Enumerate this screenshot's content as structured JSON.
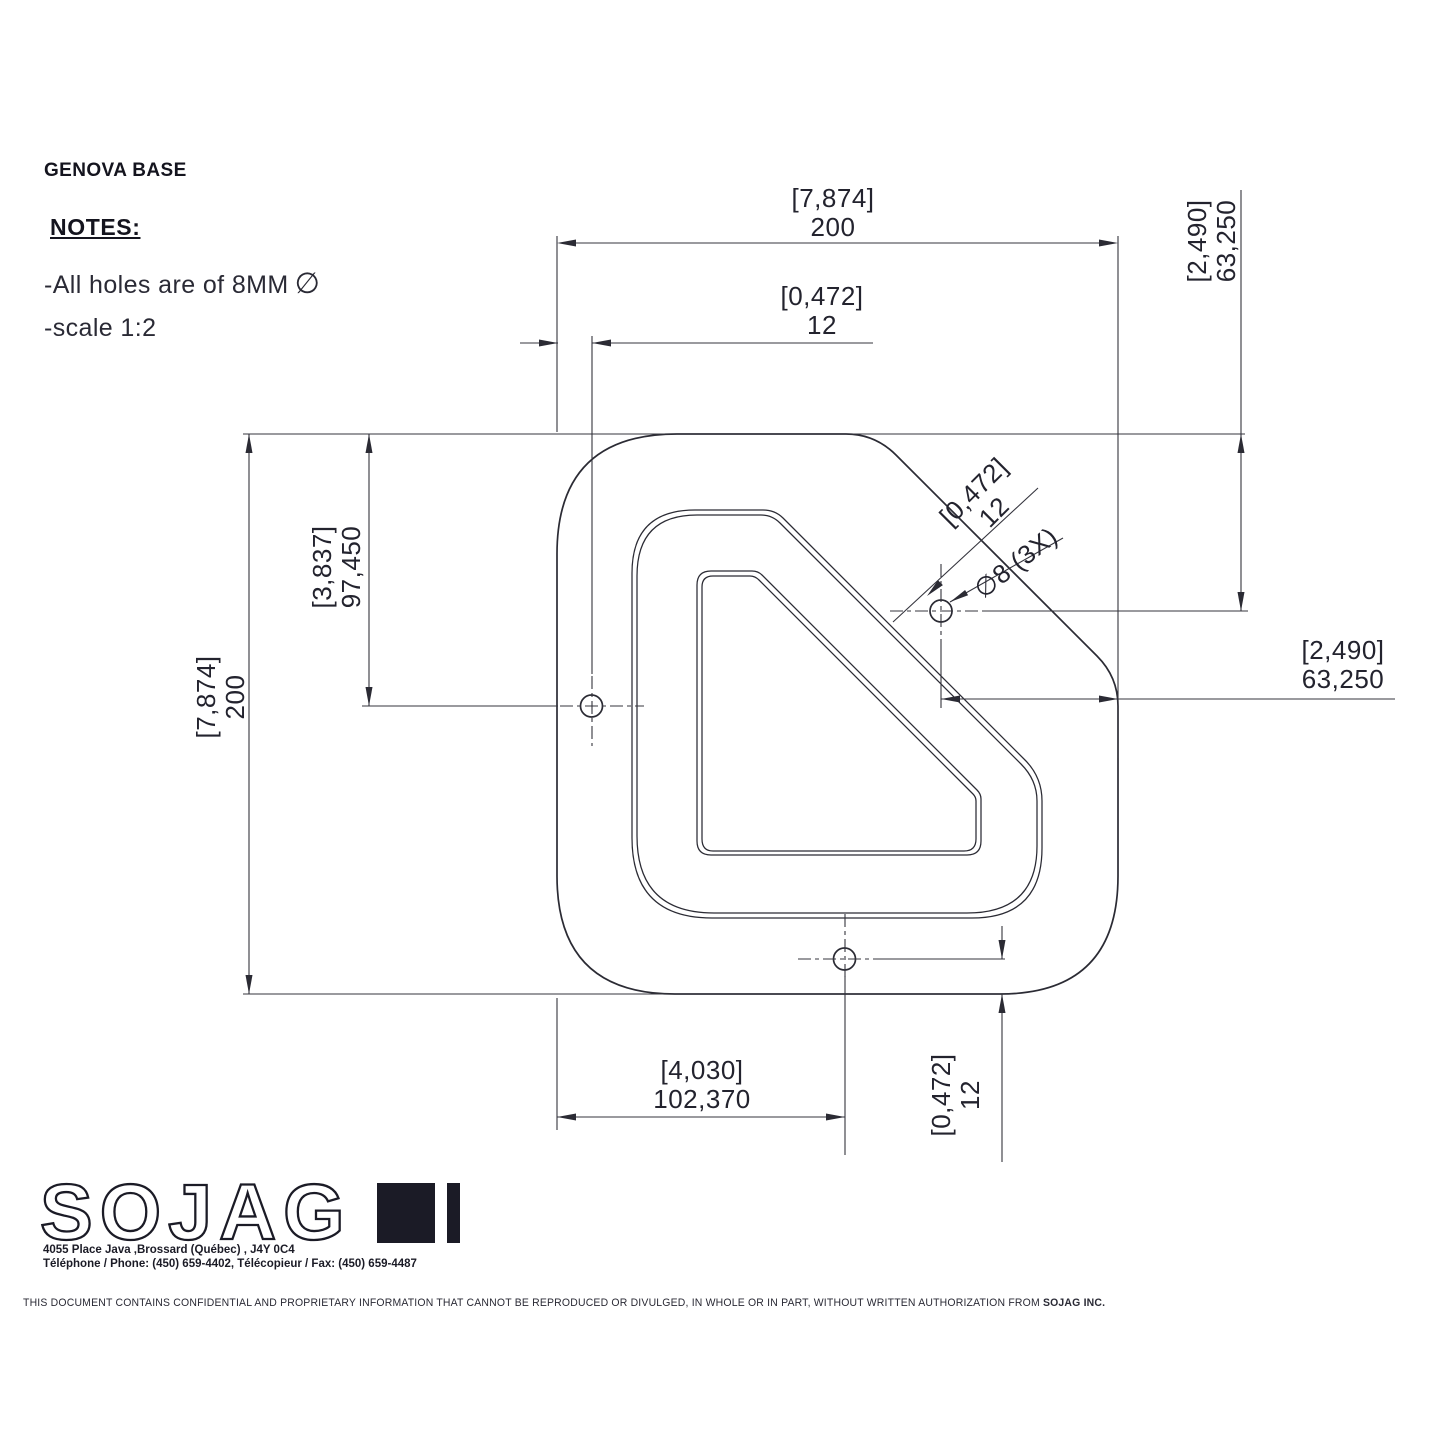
{
  "title": "GENOVA BASE",
  "notes": {
    "heading": "NOTES:",
    "line1": "-All holes are of 8MM",
    "line1_symbol": "∅",
    "line2": "-scale 1:2"
  },
  "dims": {
    "top_width": {
      "inches": "[7,874]",
      "mm": "200"
    },
    "top_hole_offset": {
      "inches": "[0,472]",
      "mm": "12"
    },
    "left_height": {
      "inches": "[7,874]",
      "mm": "200"
    },
    "left_hole_height": {
      "inches": "[3,837]",
      "mm": "97,450"
    },
    "tr_hole_top": {
      "inches": "[2,490]",
      "mm": "63,250"
    },
    "tr_hole_right": {
      "inches": "[2,490]",
      "mm": "63,250"
    },
    "diag_edge_offset": {
      "inches": "[0,472]",
      "mm": "12"
    },
    "hole_callout": "∅8 (3X)",
    "bottom_hole_x": {
      "inches": "[4,030]",
      "mm": "102,370"
    },
    "bottom_hole_offset": {
      "inches": "[0,472]",
      "mm": "12"
    }
  },
  "logo": {
    "wordmark": "SOJAG",
    "address": "4055 Place Java ,Brossard (Québec) , J4Y 0C4",
    "phone_fax": "Téléphone / Phone: (450) 659-4402, Télécopieur / Fax: (450) 659-4487"
  },
  "footer": {
    "text": "THIS DOCUMENT CONTAINS CONFIDENTIAL AND PROPRIETARY INFORMATION THAT CANNOT BE REPRODUCED OR DIVULGED, IN WHOLE OR IN PART, WITHOUT WRITTEN AUTHORIZATION FROM ",
    "company": "SOJAG INC."
  },
  "colors": {
    "line": "#2b2b34",
    "text": "#23232e",
    "logo": "#1b1b26"
  }
}
